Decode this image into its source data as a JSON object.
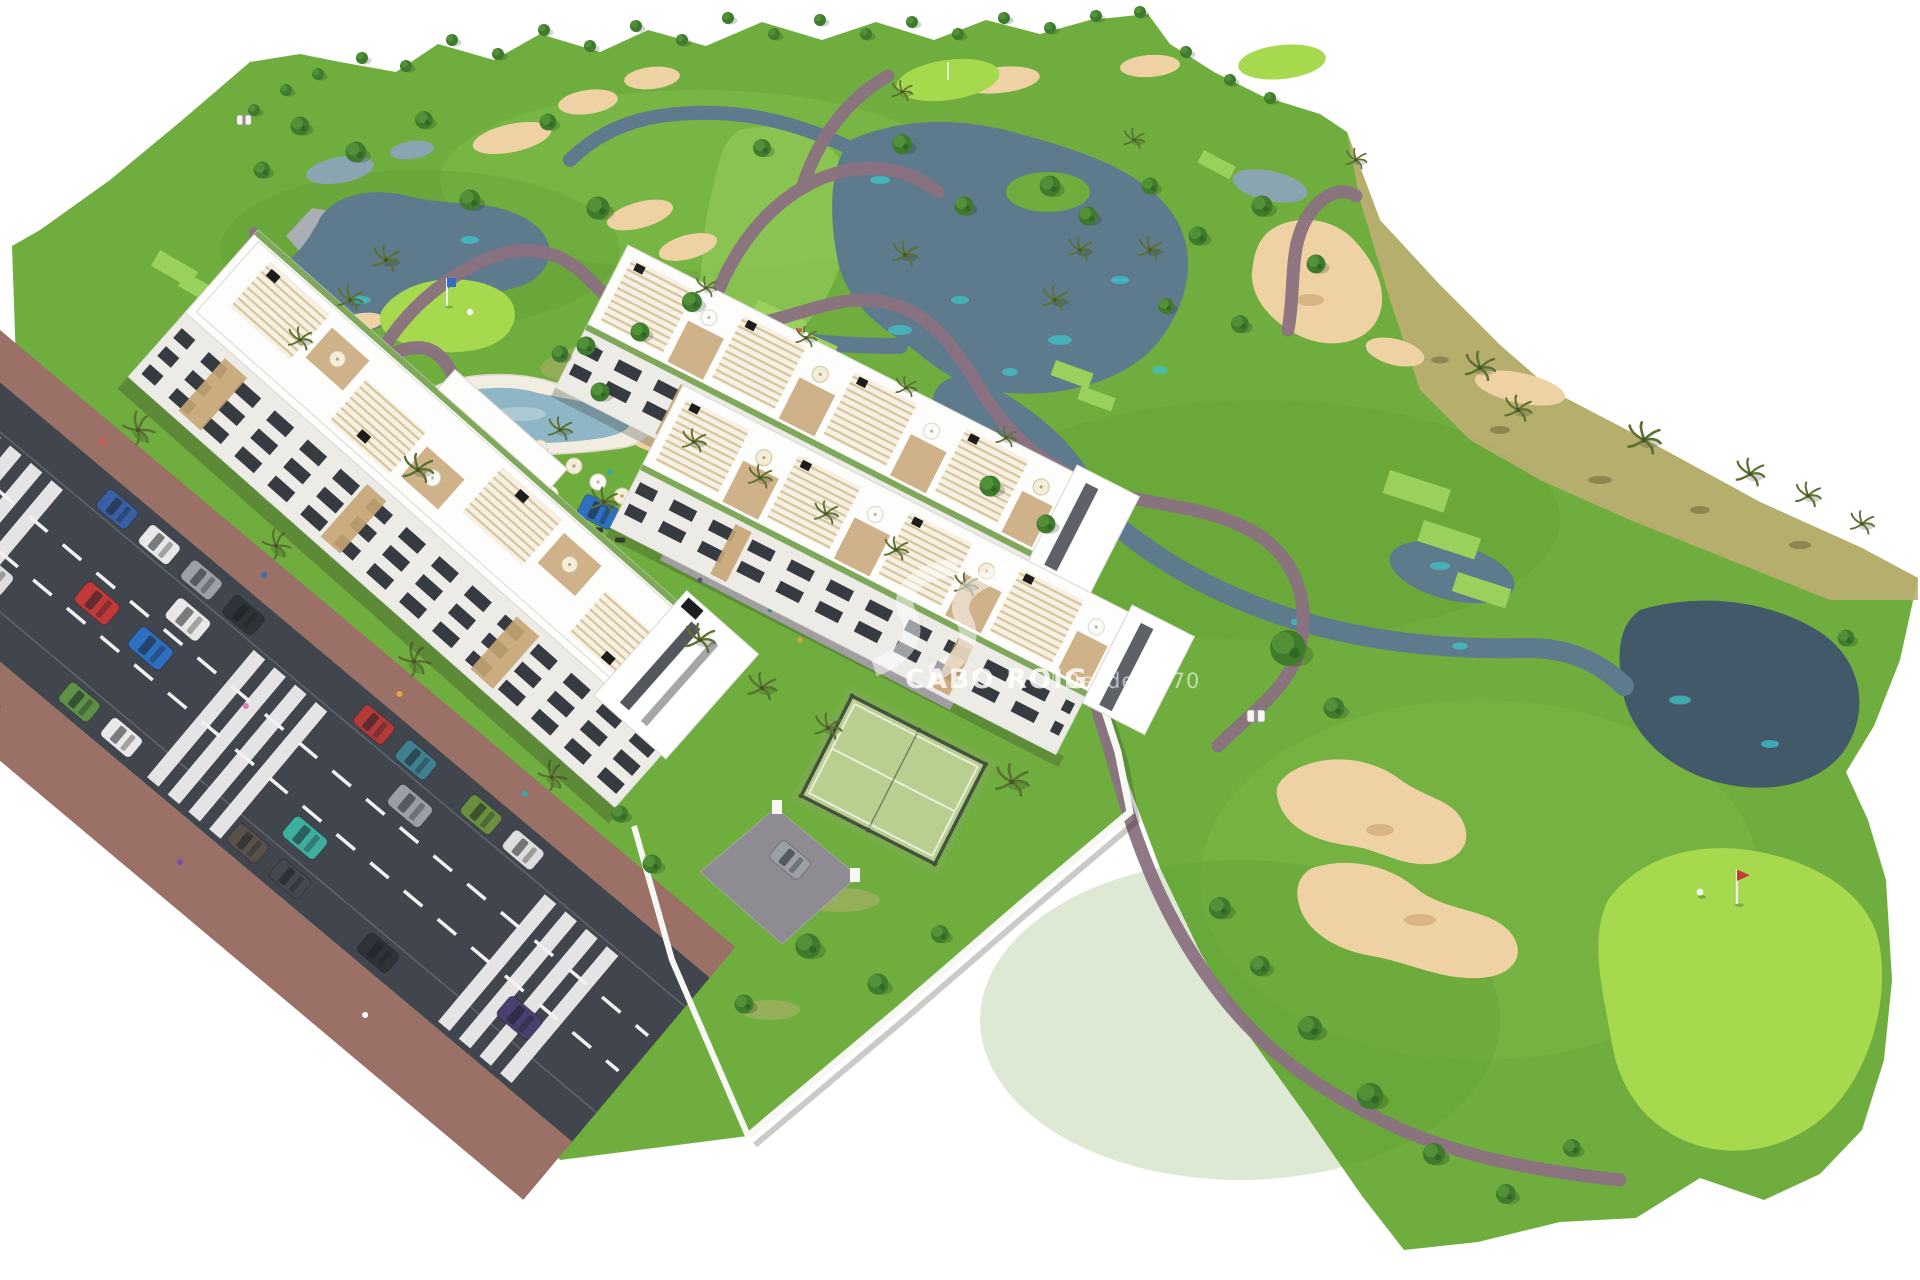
{
  "meta": {
    "image_type": "architectural-aerial-render",
    "subject": "golf resort residential development masterplan with apartment blocks, lagoon pool, padel court and golf course"
  },
  "watermark": {
    "brand": "CABO ROIG",
    "separator": "|",
    "tagline": "Desde 1970"
  },
  "palette": {
    "bg": "#ffffff",
    "fairway": "#6fae3e",
    "fairwayLight": "#8cc653",
    "rough": "#55912e",
    "brightGreen": "#a6d94e",
    "tee": "#9ad05c",
    "lawn": "#7cab51",
    "scrub": "#bcae72",
    "scrubDot": "#8f854f",
    "water": "#5d7b8c",
    "waterDark": "#42596a",
    "waterLight": "#8aa5b2",
    "waterAccent": "#3fc4c9",
    "sand": "#eed2a3",
    "sandShadow": "#d9b586",
    "path": "#8b7181",
    "road": "#41454d",
    "roadLine": "#f2f2f2",
    "sidewalk": "#9a7067",
    "plaza": "#c9c4cd",
    "plazaBand": "#8e8896",
    "drive": "#8f8b92",
    "roof": "#fdfdfb",
    "roofLine": "#d9d7d0",
    "facade": "#ecebe6",
    "window": "#363b42",
    "wood": "#c7a574",
    "pergola": "#d8c49a",
    "pergolaBg": "#f6f1e4",
    "planter": "#7fa85a",
    "black": "#1d1d1d",
    "wall": "#f7f7f3",
    "shadow": "#2a2d23",
    "pool": "#8fb6c6",
    "poolDeck": "#f1ede1",
    "court": "#b9cf92",
    "courtLine": "#e8efd8",
    "courtFence": "#46523f",
    "tree": "#3e7b2d",
    "treeLight": "#57953c",
    "treeDark": "#2c5c20",
    "palm": "#5c7034",
    "palmDark": "#46561f",
    "rock": "#a9aeb4",
    "rockDark": "#878d94",
    "cart": "#f6f6f4"
  },
  "car_colors": [
    "#3b5fa5",
    "#e8e8e8",
    "#9aa0a6",
    "#2e3338",
    "#b23a38",
    "#3f7f8f",
    "#6a8f3f",
    "#dddddd",
    "#44484f",
    "#c03a3a",
    "#2f6fbf",
    "#3fae9f",
    "#4a3f6f",
    "#cccccc",
    "#5d8f45",
    "#59504a",
    "#8a63a8",
    "#2f6f4f"
  ],
  "person_colors": [
    "#d9534f",
    "#3a6ea8",
    "#e8a33d",
    "#3aa89a",
    "#444444",
    "#ffffff",
    "#7b4fa0",
    "#d97fb0"
  ],
  "scene": {
    "features": [
      "golf-course-terrain",
      "lakes",
      "streams",
      "sand-bunkers",
      "putting-greens",
      "tee-boxes",
      "cart-paths",
      "rocks",
      "trees",
      "palm-trees",
      "scrub-edge",
      "apartment-block-west",
      "townhouse-row-north",
      "townhouse-row-south",
      "lagoon-pool",
      "sun-lounger-lawn",
      "playground-plaza",
      "padel-court",
      "perimeter-walls",
      "entrance-driveway",
      "access-road",
      "sidewalks",
      "crosswalks",
      "parked-cars",
      "moving-cars",
      "pedestrians",
      "golf-cart",
      "golfer-on-green",
      "flag-pins",
      "watermark-logo"
    ]
  }
}
